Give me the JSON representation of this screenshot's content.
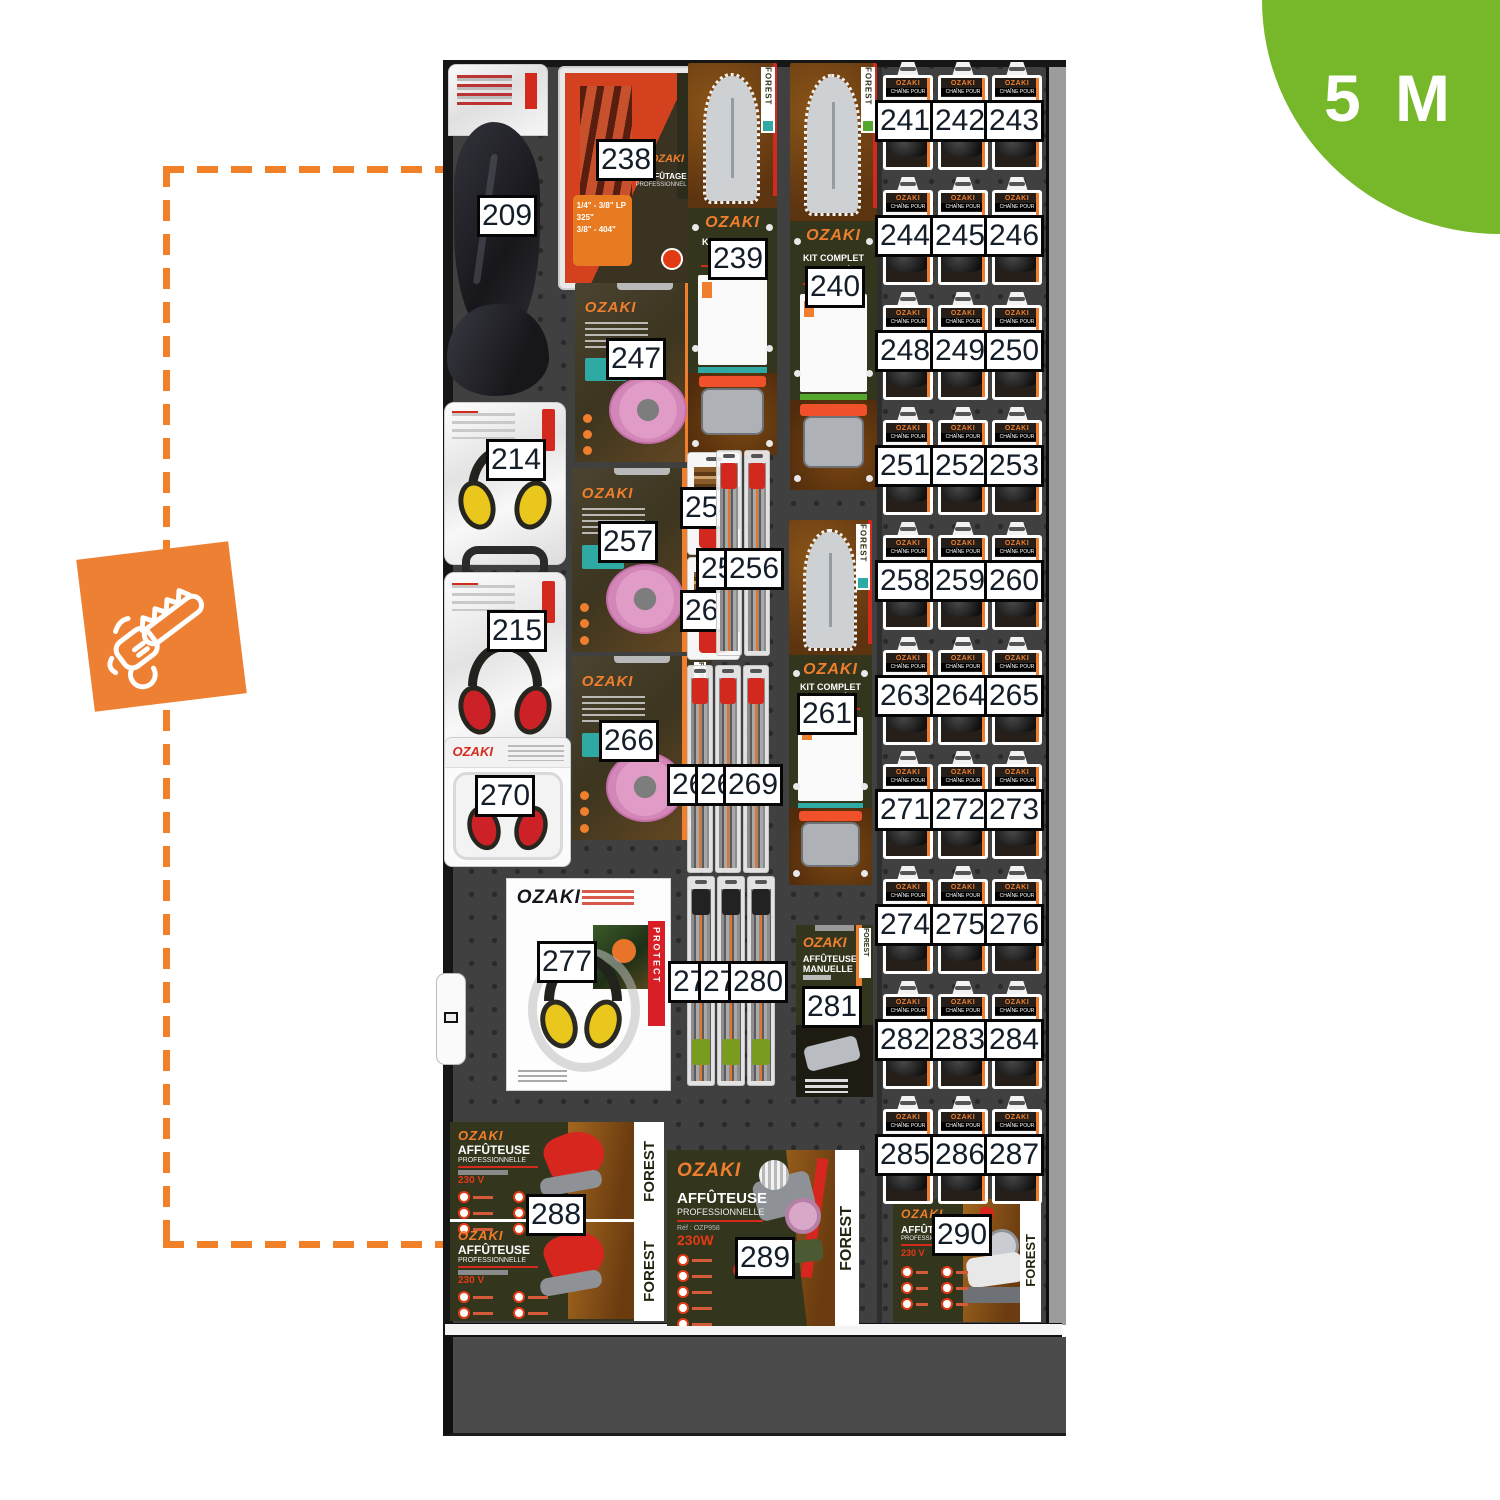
{
  "badge": {
    "label": "5 M",
    "color": "#76b82a"
  },
  "legend": {
    "icon": "chainsaw-icon",
    "tile_color": "#ee8033",
    "dash_color": "#f08129"
  },
  "brand": "OZAKI",
  "tags": {
    "forest": "FOREST",
    "protect": "PROTECT"
  },
  "cards": {
    "kit_complet": {
      "title": "KIT COMPLET",
      "subtitle": "GUIDE + CHAÎNE"
    },
    "kit_affutage": {
      "title": "KIT AFFÛTAGE",
      "subtitle": "PROFESSIONNEL",
      "sizes": [
        "1/4\" - 3/8\" LP",
        "325\"",
        "3/8\" - 404\""
      ]
    },
    "chain_card": {
      "brand": "OZAKI",
      "line": "CHAÎNE POUR"
    },
    "manual_card": {
      "title": "AFFÛTEUSE",
      "subtitle": "MANUELLE"
    }
  },
  "banners": {
    "b288": {
      "brand": "OZAKI",
      "title": "AFFÛTEUSE",
      "subtitle": "PROFESSIONNELLE",
      "power": "230 V",
      "tag": "FOREST"
    },
    "b289": {
      "brand": "OZAKI",
      "title": "AFFÛTEUSE",
      "subtitle": "PROFESSIONNELLE",
      "ref": "Réf : OZP958",
      "power": "230W",
      "tag": "FOREST"
    },
    "b290": {
      "brand": "OZAKI",
      "title": "AFFÛTEUSE",
      "subtitle": "PROFESSIONNELLE",
      "power": "230 V",
      "tag": "FOREST"
    }
  },
  "colors": {
    "teal": "#2fa9a4",
    "green": "#55a82c",
    "blue": "#2d9fd8",
    "orange": "#f07f2d",
    "red_handle": "#d2281e",
    "green_handle": "#7a9c1e",
    "muff_yellow": "#e9c71d",
    "muff_red": "#cc2127"
  },
  "products": [
    {
      "num": 209,
      "kind": "bag",
      "x": 448,
      "y": 64,
      "w": 100,
      "h": 338,
      "lx": 510,
      "ly": 219
    },
    {
      "num": 238,
      "kind": "kitaff",
      "x": 558,
      "y": 66,
      "w": 142,
      "h": 224,
      "lx": 629,
      "ly": 163
    },
    {
      "num": 247,
      "kind": "wheel",
      "x": 575,
      "y": 283,
      "w": 140,
      "h": 179,
      "lx": 639,
      "ly": 362
    },
    {
      "num": 257,
      "kind": "wheel",
      "x": 572,
      "y": 468,
      "w": 140,
      "h": 184,
      "lx": 631,
      "ly": 545
    },
    {
      "num": 266,
      "kind": "wheel",
      "x": 572,
      "y": 656,
      "w": 140,
      "h": 184,
      "lx": 632,
      "ly": 744
    },
    {
      "num": 214,
      "kind": "muffbag",
      "color": "muff_yellow",
      "x": 444,
      "y": 402,
      "w": 122,
      "h": 163,
      "lx": 519,
      "ly": 463
    },
    {
      "num": 215,
      "kind": "muffbag",
      "color": "muff_red",
      "handle": true,
      "x": 444,
      "y": 572,
      "w": 122,
      "h": 206,
      "lx": 520,
      "ly": 634
    },
    {
      "num": 270,
      "kind": "muffblister",
      "x": 444,
      "y": 737,
      "w": 127,
      "h": 130,
      "lx": 508,
      "ly": 799
    },
    {
      "num": 277,
      "kind": "muffcard",
      "x": 506,
      "y": 878,
      "w": 165,
      "h": 213,
      "lx": 570,
      "ly": 965
    },
    {
      "num": 239,
      "kind": "kitc",
      "accent": "teal",
      "x": 688,
      "y": 63,
      "w": 89,
      "h": 392,
      "lx": 741,
      "ly": 262
    },
    {
      "num": 240,
      "kind": "kitc",
      "accent": "green",
      "x": 790,
      "y": 63,
      "w": 87,
      "h": 427,
      "lx": 838,
      "ly": 290
    },
    {
      "num": 261,
      "kind": "kitc",
      "accent": "teal",
      "x": 789,
      "y": 520,
      "w": 83,
      "h": 365,
      "lx": 830,
      "ly": 717
    },
    {
      "num": 254,
      "kind": "filepkS",
      "x": 687,
      "y": 452,
      "w": 53,
      "h": 103,
      "lx": 713,
      "ly": 511
    },
    {
      "num": 262,
      "kind": "filepkS",
      "x": 687,
      "y": 557,
      "w": 53,
      "h": 103,
      "lx": 713,
      "ly": 614
    },
    {
      "num": 255,
      "kind": "filepkL",
      "variant": "red",
      "x": 716,
      "y": 450,
      "w": 26,
      "h": 206,
      "lx": 729,
      "ly": 572
    },
    {
      "num": 256,
      "kind": "filepkL",
      "variant": "red",
      "x": 744,
      "y": 450,
      "w": 26,
      "h": 206,
      "lx": 757,
      "ly": 572
    },
    {
      "num": 267,
      "kind": "filepkL",
      "variant": "red",
      "x": 687,
      "y": 665,
      "w": 26,
      "h": 208,
      "lx": 700,
      "ly": 788
    },
    {
      "num": 268,
      "kind": "filepkL",
      "variant": "red",
      "x": 715,
      "y": 665,
      "w": 26,
      "h": 208,
      "lx": 728,
      "ly": 788
    },
    {
      "num": 269,
      "kind": "filepkL",
      "variant": "red",
      "x": 743,
      "y": 665,
      "w": 26,
      "h": 208,
      "lx": 756,
      "ly": 788
    },
    {
      "num": 278,
      "kind": "filepkL",
      "variant": "green",
      "x": 687,
      "y": 876,
      "w": 28,
      "h": 210,
      "lx": 701,
      "ly": 985
    },
    {
      "num": 279,
      "kind": "filepkL",
      "variant": "green",
      "x": 717,
      "y": 876,
      "w": 28,
      "h": 210,
      "lx": 731,
      "ly": 985
    },
    {
      "num": 280,
      "kind": "filepkL",
      "variant": "green",
      "x": 747,
      "y": 876,
      "w": 28,
      "h": 210,
      "lx": 761,
      "ly": 985
    },
    {
      "num": 281,
      "kind": "manual",
      "x": 796,
      "y": 925,
      "w": 77,
      "h": 172,
      "lx": 835,
      "ly": 1010
    },
    {
      "num": 288,
      "kind": "banner288",
      "x": 450,
      "y": 1122,
      "w": 214,
      "h": 199,
      "lx": 559,
      "ly": 1218
    },
    {
      "num": 289,
      "kind": "banner289",
      "x": 667,
      "y": 1150,
      "w": 192,
      "h": 176,
      "lx": 768,
      "ly": 1261
    },
    {
      "num": 290,
      "kind": "banner290",
      "x": 893,
      "y": 1199,
      "w": 148,
      "h": 123,
      "lx": 965,
      "ly": 1238
    }
  ],
  "chain_grid": {
    "cols_x": [
      883,
      938,
      992
    ],
    "card_w": 50,
    "card_h": 108,
    "rows": [
      {
        "y": 62,
        "nums": [
          241,
          242,
          243
        ],
        "bands": [
          "teal",
          "teal",
          "teal"
        ]
      },
      {
        "y": 177,
        "nums": [
          244,
          245,
          246
        ],
        "bands": [
          "teal",
          "teal",
          "teal"
        ]
      },
      {
        "y": 292,
        "nums": [
          248,
          249,
          250
        ],
        "bands": [
          "teal",
          "teal",
          "teal"
        ]
      },
      {
        "y": 407,
        "nums": [
          251,
          252,
          253
        ],
        "bands": [
          "teal",
          "teal",
          "teal"
        ]
      },
      {
        "y": 522,
        "nums": [
          258,
          259,
          260
        ],
        "bands": [
          "green",
          "green",
          "green"
        ]
      },
      {
        "y": 637,
        "nums": [
          263,
          264,
          265
        ],
        "bands": [
          "green",
          "green",
          "green"
        ]
      },
      {
        "y": 751,
        "nums": [
          271,
          272,
          273
        ],
        "bands": [
          "green",
          "green",
          "green"
        ]
      },
      {
        "y": 866,
        "nums": [
          274,
          275,
          276
        ],
        "bands": [
          "green",
          "blue",
          "blue"
        ]
      },
      {
        "y": 981,
        "nums": [
          282,
          283,
          284
        ],
        "bands": [
          "blue",
          "blue",
          "blue"
        ]
      },
      {
        "y": 1096,
        "nums": [
          285,
          286,
          287
        ],
        "bands": [
          "blue",
          "blue",
          "blue"
        ]
      }
    ]
  }
}
